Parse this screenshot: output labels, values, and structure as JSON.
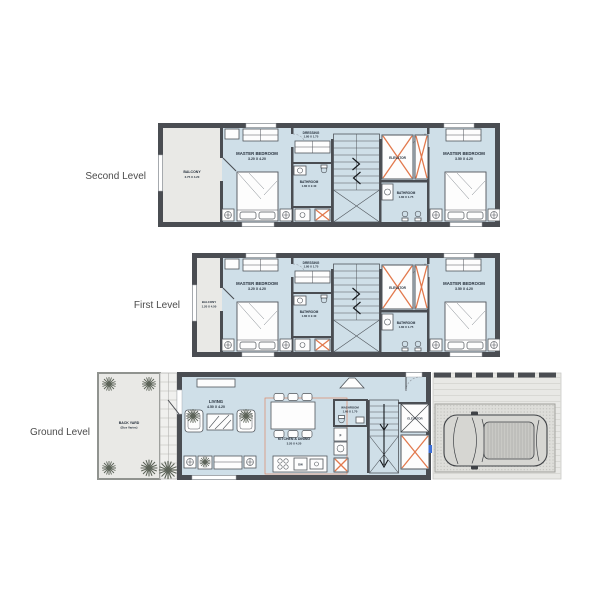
{
  "colors": {
    "floor": "#cfdfe8",
    "outdoor": "#e9e9e6",
    "wall": "#4a4d52",
    "accent_x": "#e2794d",
    "pavement": "#e8e8e5",
    "text": "#26303c"
  },
  "levels": [
    {
      "label": "Second Level",
      "rooms": {
        "balcony": {
          "name": "BALCONY",
          "dims": "2.75 X 4.20"
        },
        "master_bedroom_left": {
          "name": "MASTER BEDROOM",
          "dims": "3.20 X 4.20"
        },
        "dressing": {
          "name": "DRESSING",
          "dims": "1.80 X 1.75"
        },
        "bathroom_left": {
          "name": "BATHROOM",
          "dims": "1.80 X 2.40"
        },
        "elevator": {
          "name": "ELEVATOR"
        },
        "bathroom_right": {
          "name": "BATHROOM",
          "dims": "1.80 X 1.75"
        },
        "master_bedroom_right": {
          "name": "MASTER BEDROOM",
          "dims": "3.50 X 4.20"
        }
      }
    },
    {
      "label": "First Level",
      "rooms": {
        "balcony": {
          "name": "BALCONY",
          "dims": "1.20 X 4.50"
        },
        "master_bedroom_left": {
          "name": "MASTER BEDROOM",
          "dims": "3.20 X 4.20"
        },
        "dressing": {
          "name": "DRESSING",
          "dims": "1.80 X 1.75"
        },
        "bathroom_left": {
          "name": "BATHROOM",
          "dims": "1.80 X 2.40"
        },
        "elevator": {
          "name": "ELEVATOR"
        },
        "bathroom_right": {
          "name": "BATHROOM",
          "dims": "1.80 X 1.75"
        },
        "master_bedroom_right": {
          "name": "MASTER BEDROOM",
          "dims": "3.50 X 4.20"
        }
      }
    },
    {
      "label": "Ground Level",
      "rooms": {
        "back_yard": {
          "name": "BACK YARD",
          "dims": "(Size Varies)"
        },
        "living": {
          "name": "LIVING",
          "dims": "4.50 X 4.20"
        },
        "kitchen_dining": {
          "name": "KITCHEN & DINING",
          "dims": "3.20 X 4.20"
        },
        "washroom": {
          "name": "WASHROOM",
          "dims": "1.60 X 1.70"
        },
        "elevator": {
          "name": "ELEVATOR"
        }
      },
      "appliances": {
        "dishwasher": "DW",
        "fridge": "F"
      }
    }
  ]
}
